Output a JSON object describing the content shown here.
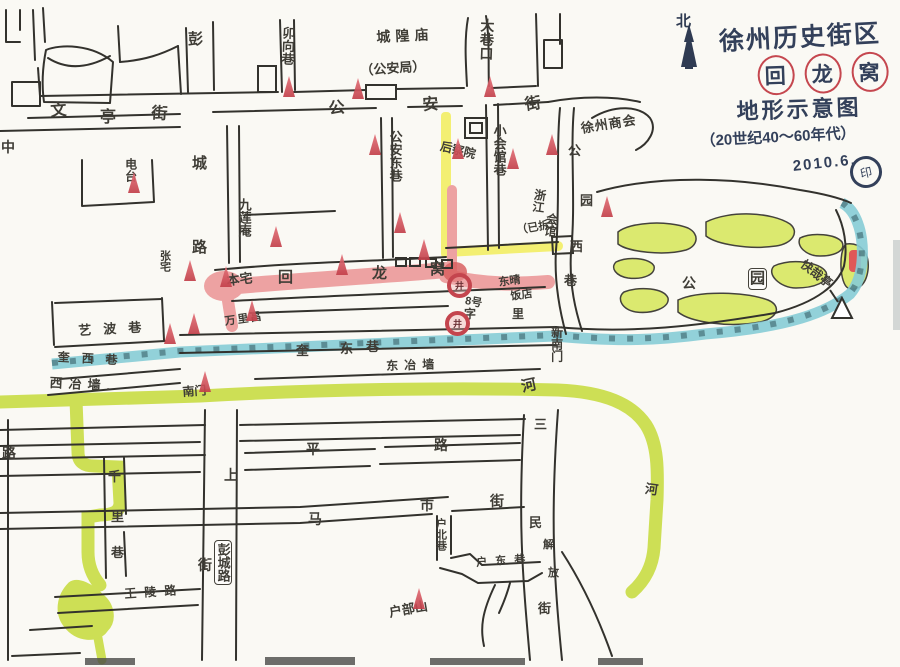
{
  "title": {
    "line1": "徐州历史街区",
    "line2": "回龙窝",
    "line3": "地形示意图",
    "line4": "（20世纪40～60年代）",
    "date": "2010.6.",
    "seal": "印",
    "compass": "北"
  },
  "colors": {
    "ink": "#33322d",
    "title_ink": "#33405a",
    "river": "#cddf55",
    "wall": "#86ccd6",
    "street_pink": "#eda2a2",
    "lane_yellow": "#f3ef72",
    "park_green": "#dbe96f",
    "marker_red": "#c43f49"
  },
  "labels": [
    {
      "n": "lane-maoxiangxiang",
      "t": "卯向巷",
      "x": 281,
      "y": 26,
      "v": 1,
      "s": 13,
      "r": 2
    },
    {
      "n": "place-chenghuangmiao",
      "t": "城隍庙",
      "x": 376,
      "y": 30,
      "s": 14,
      "sp": 5,
      "r": -3
    },
    {
      "n": "place-gonganju",
      "t": "（公安局）",
      "x": 360,
      "y": 64,
      "s": 13,
      "r": -4
    },
    {
      "n": "lane-daxiangkou",
      "t": "大巷口",
      "x": 480,
      "y": 18,
      "v": 1,
      "s": 14,
      "r": 2
    },
    {
      "n": "street-gongan-char1",
      "t": "公",
      "x": 328,
      "y": 102,
      "s": 16,
      "r": -6
    },
    {
      "n": "street-gongan-char2",
      "t": "安",
      "x": 422,
      "y": 98,
      "s": 16,
      "r": -4
    },
    {
      "n": "street-gongan-char3",
      "t": "街",
      "x": 524,
      "y": 98,
      "s": 16,
      "r": -8
    },
    {
      "n": "street-wenting-char1",
      "t": "文",
      "x": 50,
      "y": 104,
      "s": 16,
      "r": -4
    },
    {
      "n": "street-wenting-char2",
      "t": "亭",
      "x": 100,
      "y": 110,
      "s": 16
    },
    {
      "n": "street-wenting-char3",
      "t": "街",
      "x": 152,
      "y": 106,
      "s": 16,
      "r": 4
    },
    {
      "n": "street-pengcheng-char1",
      "t": "彭",
      "x": 188,
      "y": 32,
      "s": 15
    },
    {
      "n": "street-pengcheng-char2",
      "t": "城",
      "x": 192,
      "y": 156,
      "s": 15
    },
    {
      "n": "street-pengcheng-char3",
      "t": "路",
      "x": 192,
      "y": 240,
      "s": 15
    },
    {
      "n": "street-zhongshan-char1",
      "t": "中",
      "x": 1,
      "y": 140,
      "s": 14
    },
    {
      "n": "street-zhongshan-char2",
      "t": "路",
      "x": 2,
      "y": 446,
      "s": 14
    },
    {
      "n": "place-diantai",
      "t": "电台",
      "x": 124,
      "y": 158,
      "v": 1,
      "s": 12
    },
    {
      "n": "place-shanghui",
      "t": "徐州商会",
      "x": 580,
      "y": 122,
      "s": 13,
      "r": -9,
      "sp": 1
    },
    {
      "n": "lane-gongandong",
      "t": "公安东巷",
      "x": 388,
      "y": 130,
      "v": 1,
      "s": 13
    },
    {
      "n": "place-houchayuan",
      "t": "后察院",
      "x": 442,
      "y": 140,
      "s": 12,
      "r": 14
    },
    {
      "n": "lane-xiaohuiguan",
      "t": "小会馆巷",
      "x": 492,
      "y": 124,
      "v": 1,
      "s": 13
    },
    {
      "n": "place-jiulianan",
      "t": "九莲庵",
      "x": 237,
      "y": 198,
      "v": 1,
      "s": 13
    },
    {
      "n": "place-zhejiang-huiguan-1",
      "t": "浙江",
      "x": 534,
      "y": 188,
      "v": 1,
      "s": 12,
      "r": 8
    },
    {
      "n": "place-zhejiang-huiguan-2",
      "t": "会馆",
      "x": 546,
      "y": 212,
      "v": 1,
      "s": 12,
      "r": 8
    },
    {
      "n": "place-zhejiang-note",
      "t": "（已拆）",
      "x": 516,
      "y": 226,
      "s": 11,
      "r": -10
    },
    {
      "n": "lane-gongyuanxi-char1",
      "t": "公",
      "x": 568,
      "y": 144,
      "s": 13
    },
    {
      "n": "lane-gongyuanxi-char2",
      "t": "园",
      "x": 580,
      "y": 194,
      "s": 13
    },
    {
      "n": "lane-gongyuanxi-char3",
      "t": "西",
      "x": 570,
      "y": 240,
      "s": 13
    },
    {
      "n": "lane-gongyuanxi-char4",
      "t": "巷",
      "x": 564,
      "y": 274,
      "s": 13
    },
    {
      "n": "gate-xinnanmen",
      "t": "新南门",
      "x": 550,
      "y": 326,
      "v": 1,
      "s": 12
    },
    {
      "n": "street-huilongwo-char1",
      "t": "回",
      "x": 278,
      "y": 270,
      "s": 15
    },
    {
      "n": "street-huilongwo-char2",
      "t": "龙",
      "x": 372,
      "y": 266,
      "s": 15
    },
    {
      "n": "street-huilongwo-char3",
      "t": "窝",
      "x": 430,
      "y": 262,
      "s": 15
    },
    {
      "n": "place-benzhai",
      "t": "本宅",
      "x": 226,
      "y": 274,
      "s": 13,
      "r": -6
    },
    {
      "n": "place-zhangzhai",
      "t": "张宅",
      "x": 158,
      "y": 250,
      "v": 1,
      "s": 11
    },
    {
      "n": "shop-wanlichang",
      "t": "万里昌",
      "x": 224,
      "y": 317,
      "s": 11,
      "r": -8,
      "sp": 2
    },
    {
      "n": "house-no8",
      "t": "8号",
      "x": 466,
      "y": 296,
      "s": 11,
      "r": 10
    },
    {
      "n": "shop-fandian-1",
      "t": "东晴",
      "x": 498,
      "y": 278,
      "s": 11,
      "r": -8
    },
    {
      "n": "shop-fandian-2",
      "t": "饭店",
      "x": 510,
      "y": 292,
      "s": 11,
      "r": -8
    },
    {
      "n": "street-jingzili-char1",
      "t": "字",
      "x": 464,
      "y": 308,
      "s": 12
    },
    {
      "n": "street-jingzili-char2",
      "t": "里",
      "x": 512,
      "y": 308,
      "s": 12
    },
    {
      "n": "lane-kuidong-char1",
      "t": "奎",
      "x": 296,
      "y": 344,
      "s": 13
    },
    {
      "n": "lane-kuidong-char2",
      "t": "东",
      "x": 340,
      "y": 342,
      "s": 13
    },
    {
      "n": "lane-kuidong-char3",
      "t": "巷",
      "x": 366,
      "y": 340,
      "s": 13
    },
    {
      "n": "street-dongyeqiang",
      "t": "东冶墙",
      "x": 386,
      "y": 360,
      "s": 12,
      "sp": 6,
      "r": -2
    },
    {
      "n": "lane-kuixi",
      "t": "奎西巷",
      "x": 58,
      "y": 351,
      "s": 12,
      "sp": 12,
      "r": 3
    },
    {
      "n": "street-xiyeqiang",
      "t": "西冶墙.",
      "x": 50,
      "y": 376,
      "s": 13,
      "sp": 6,
      "r": 3
    },
    {
      "n": "lane-yibo",
      "t": "艺波巷",
      "x": 78,
      "y": 324,
      "s": 13,
      "sp": 12,
      "r": -3
    },
    {
      "n": "gate-nanmen",
      "t": "南门",
      "x": 182,
      "y": 386,
      "s": 12,
      "r": -4
    },
    {
      "n": "river-kuihe",
      "t": "河",
      "x": 520,
      "y": 380,
      "s": 15,
      "r": -12
    },
    {
      "n": "river-east",
      "t": "河",
      "x": 646,
      "y": 482,
      "s": 13,
      "r": 8
    },
    {
      "n": "lane-qianli-char1",
      "t": "千",
      "x": 108,
      "y": 470,
      "s": 13
    },
    {
      "n": "lane-qianli-char2",
      "t": "里",
      "x": 111,
      "y": 510,
      "s": 13
    },
    {
      "n": "lane-qianli-char3",
      "t": "巷",
      "x": 111,
      "y": 546,
      "s": 13
    },
    {
      "n": "street-shangjie-char1",
      "t": "上",
      "x": 224,
      "y": 468,
      "s": 14
    },
    {
      "n": "street-shangjie-char2",
      "t": "街",
      "x": 198,
      "y": 558,
      "s": 14
    },
    {
      "n": "sign-pengchenglu",
      "t": "彭城路",
      "x": 214,
      "y": 540,
      "v": 1,
      "s": 13,
      "box": 1
    },
    {
      "n": "street-pinglu-char1",
      "t": "平",
      "x": 306,
      "y": 442,
      "s": 14
    },
    {
      "n": "street-pinglu-char2",
      "t": "路",
      "x": 434,
      "y": 438,
      "s": 14
    },
    {
      "n": "street-mashi-char1",
      "t": "马",
      "x": 308,
      "y": 512,
      "s": 14
    },
    {
      "n": "street-mashi-char2",
      "t": "市",
      "x": 420,
      "y": 498,
      "s": 14
    },
    {
      "n": "street-mashi-char3",
      "t": "街",
      "x": 490,
      "y": 494,
      "s": 14
    },
    {
      "n": "lane-hubei",
      "t": "户北巷",
      "x": 434,
      "y": 518,
      "v": 1,
      "s": 11
    },
    {
      "n": "lane-hudong",
      "t": "户东巷",
      "x": 476,
      "y": 558,
      "s": 11,
      "sp": 8,
      "r": -4
    },
    {
      "n": "place-hubushan",
      "t": "户部山",
      "x": 388,
      "y": 606,
      "s": 13,
      "r": -10
    },
    {
      "n": "street-wangling",
      "t": "王陵路",
      "x": 124,
      "y": 588,
      "s": 12,
      "sp": 8,
      "r": -4
    },
    {
      "n": "street-sanmin-char1",
      "t": "三",
      "x": 534,
      "y": 418,
      "s": 13
    },
    {
      "n": "street-sanmin-char2",
      "t": "民",
      "x": 529,
      "y": 516,
      "s": 13
    },
    {
      "n": "street-jiefang-char1",
      "t": "解",
      "x": 543,
      "y": 540,
      "s": 11
    },
    {
      "n": "street-jiefang-char2",
      "t": "放",
      "x": 548,
      "y": 568,
      "s": 11
    },
    {
      "n": "street-sanmin-char3",
      "t": "街",
      "x": 538,
      "y": 602,
      "s": 13
    },
    {
      "n": "park-label-gong",
      "t": "公",
      "x": 682,
      "y": 276,
      "s": 14
    },
    {
      "n": "park-label-yuan",
      "t": "园",
      "x": 748,
      "y": 268,
      "s": 15,
      "box": 1
    },
    {
      "n": "place-kuaizaiting",
      "t": "快哉亭",
      "x": 806,
      "y": 258,
      "s": 12,
      "r": 38
    }
  ],
  "markers": {
    "well_char": "井",
    "wells": [
      [
        447,
        273
      ],
      [
        445,
        311
      ]
    ],
    "cones": [
      [
        283,
        76
      ],
      [
        352,
        78
      ],
      [
        484,
        76
      ],
      [
        507,
        148
      ],
      [
        546,
        134
      ],
      [
        601,
        196
      ],
      [
        394,
        212
      ],
      [
        418,
        239
      ],
      [
        270,
        226
      ],
      [
        220,
        266
      ],
      [
        184,
        260
      ],
      [
        188,
        313
      ],
      [
        164,
        323
      ],
      [
        246,
        300
      ],
      [
        336,
        254
      ],
      [
        199,
        371
      ],
      [
        413,
        588
      ],
      [
        128,
        172
      ],
      [
        452,
        138
      ],
      [
        369,
        134
      ]
    ]
  }
}
